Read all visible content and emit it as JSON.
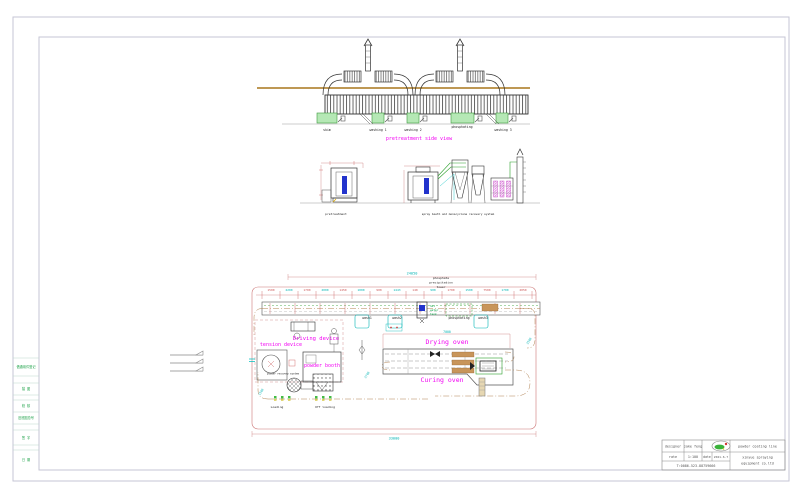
{
  "colors": {
    "label_accent": "#f200f2",
    "dimension_red": "#cc5555",
    "dimension_cyan": "#00b4b4",
    "tank_green_fill": "#b5e8b5",
    "ground_brown": "#b5893b",
    "frame_gray": "#c6c6d4",
    "equipment_blue": "#2233cc",
    "burner_tan": "#c8955a"
  },
  "frame": {
    "left_strip": [
      {
        "label": "借通用件登记"
      },
      {
        "label": "描 图"
      },
      {
        "label": "校 核"
      },
      {
        "label": "旧底图总号"
      },
      {
        "label": "签 字"
      },
      {
        "label": "日 期"
      }
    ]
  },
  "side_view": {
    "title": "pretreatment side view",
    "tanks": [
      "skim",
      "washing 1",
      "washing 2",
      "phosphating",
      "washing 3"
    ]
  },
  "elevation": {
    "left_label": "pretreatment",
    "right_label": "spray booth and monocyclone recovery system"
  },
  "plan": {
    "total_dim_top": "24050",
    "total_dim_bottom": "33000",
    "oven_dim": "7000",
    "dims": [
      "1500",
      "2200",
      "1700",
      "2000",
      "1450",
      "1000",
      "900",
      "1443",
      "140",
      "900",
      "1700",
      "1500",
      "7500",
      "1700",
      "2050"
    ],
    "diag_dims": [
      "1500",
      "2700",
      "3500"
    ],
    "labels": {
      "tower_l1": "phosphate",
      "tower_l2": "precipitation",
      "tower_l3": "tower",
      "driving_device": "Driving device",
      "tension_device": "tension device",
      "powder_booth": "powder booth",
      "powder_recovery": "powder recovery system",
      "drying_oven": "Drying oven",
      "curing_oven": "Curing oven",
      "loading": "Loading",
      "offloading": "Off loading",
      "wash1": "wash1",
      "wash2": "wash2",
      "wash3": "wash3",
      "phosphating": "phosphating",
      "hot_l1": "hot",
      "hot_l2": "water",
      "hot_l3": "tank"
    }
  },
  "title_block": {
    "designer_label": "designer",
    "designer_value": "jake feng",
    "rate_label": "rate",
    "rate_value": "1:100",
    "date_label": "date",
    "date_value": "2021.6.7",
    "phone": "T:0086-523-88759666",
    "product": "powder coating line",
    "company_l1": "xinyue spraying",
    "company_l2": "equipment co.ltd"
  }
}
